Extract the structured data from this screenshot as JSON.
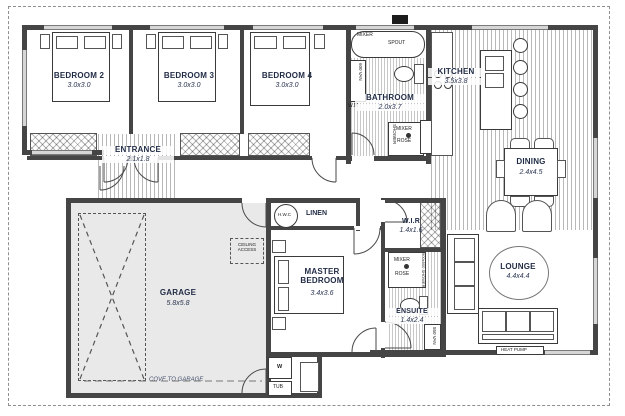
{
  "plan": {
    "title": "residential floor plan",
    "rooms": {
      "bedroom2": {
        "name": "BEDROOM 2",
        "dims": "3.0x3.0"
      },
      "bedroom3": {
        "name": "BEDROOM 3",
        "dims": "3.0x3.0"
      },
      "bedroom4": {
        "name": "BEDROOM 4",
        "dims": "3.0x3.0"
      },
      "bathroom": {
        "name": "BATHROOM",
        "dims": "2.0x3.7"
      },
      "kitchen": {
        "name": "KITCHEN",
        "dims": "3.5x3.8"
      },
      "dining": {
        "name": "DINING",
        "dims": "2.4x4.5"
      },
      "entrance": {
        "name": "ENTRANCE",
        "dims": "2.1x1.8"
      },
      "garage": {
        "name": "GARAGE",
        "dims": "5.8x5.8"
      },
      "master": {
        "name": "MASTER BEDROOM",
        "dims": "3.4x3.6"
      },
      "wir": {
        "name": "W.I.R",
        "dims": "1.4x1.6"
      },
      "ensuite": {
        "name": "ENSUITE",
        "dims": "1.4x2.4"
      },
      "lounge": {
        "name": "LOUNGE",
        "dims": "4.4x4.4"
      },
      "linen": {
        "name": "LINEN"
      }
    },
    "fixtures": {
      "mixer": "MIXER",
      "spout": "SPOUT",
      "rose": "ROSE",
      "shower": "SHOWER",
      "shower_900": "900x900 SHOWER",
      "van_600": "600 VAN",
      "van_550": "550 VAN",
      "wm": "W.M",
      "hwc": "H.W.C",
      "ceiling_access": "CEILING ACCESS",
      "cove": "COVE TO GARAGE",
      "heat_pump": "HEAT PUMP",
      "tub": "TUB",
      "w": "W"
    },
    "colors": {
      "wall": "#454545",
      "garage_fill": "#e9e9e9",
      "label_text": "#1f2a44",
      "window": "#d6d6d6",
      "boundary": "#8f8f8f"
    }
  }
}
